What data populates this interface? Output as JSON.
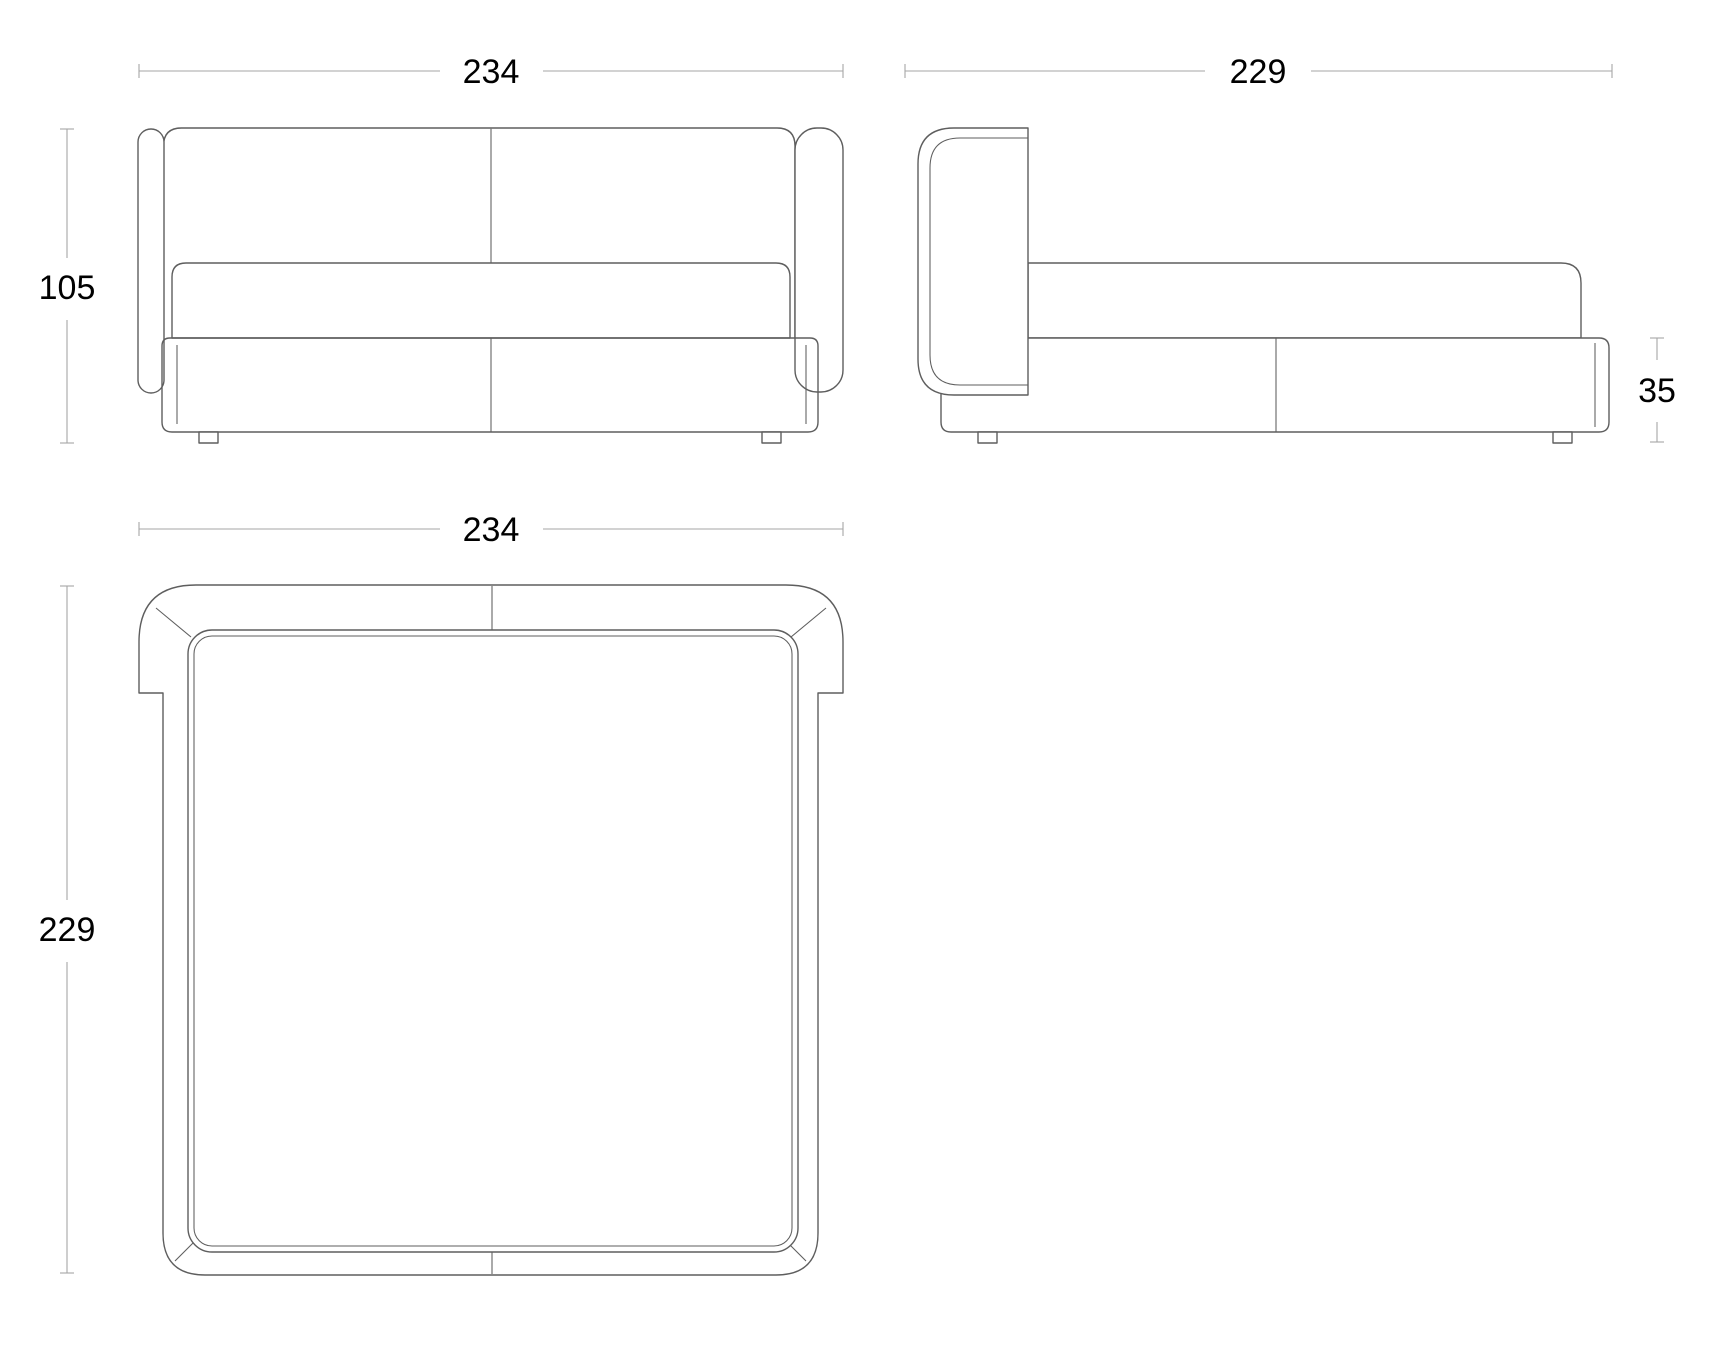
{
  "drawing": {
    "kind": "furniture technical drawing - upholstered bed, three orthographic views",
    "units_visible": false
  },
  "style": {
    "line": "#5e5e5e",
    "dim": "#a6a6a6",
    "label": "#000000",
    "background": "#ffffff"
  },
  "views": {
    "front_elevation": {
      "width": "234",
      "height": "105"
    },
    "side_elevation": {
      "depth": "229",
      "base_height": "35"
    },
    "plan": {
      "width": "234",
      "depth": "229"
    }
  },
  "dimensions_cm": {
    "overall_width": 234,
    "overall_depth": 229,
    "overall_height": 105,
    "base_height": 35
  }
}
